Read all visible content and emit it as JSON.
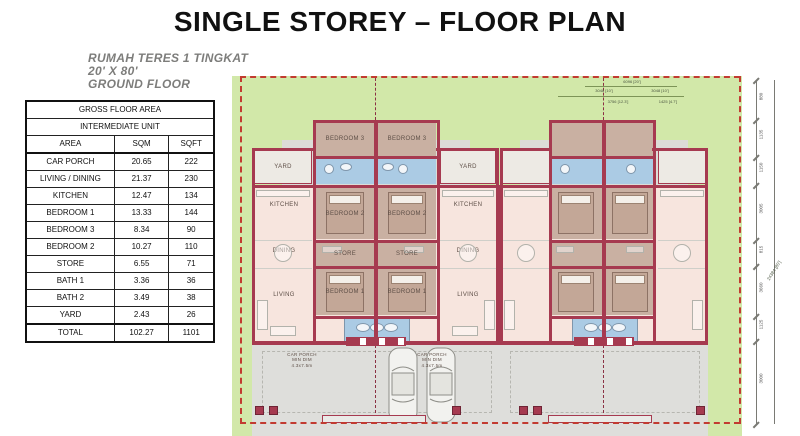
{
  "title": "SINGLE STOREY – FLOOR PLAN",
  "heading": {
    "line1": "RUMAH TERES 1 TINGKAT",
    "line2": "20' X 80'",
    "line3": "GROUND FLOOR"
  },
  "table": {
    "title": "GROSS FLOOR AREA",
    "subtitle": "INTERMEDIATE UNIT",
    "headers": [
      "AREA",
      "SQM",
      "SQFT"
    ],
    "rows": [
      {
        "area": "CAR PORCH",
        "sqm": "20.65",
        "sqft": "222"
      },
      {
        "area": "LIVING / DINING",
        "sqm": "21.37",
        "sqft": "230"
      },
      {
        "area": "KITCHEN",
        "sqm": "12.47",
        "sqft": "134"
      },
      {
        "area": "BEDROOM 1",
        "sqm": "13.33",
        "sqft": "144"
      },
      {
        "area": "BEDROOM 3",
        "sqm": "8.34",
        "sqft": "90"
      },
      {
        "area": "BEDROOM 2",
        "sqm": "10.27",
        "sqft": "110"
      },
      {
        "area": "STORE",
        "sqm": "6.55",
        "sqft": "71"
      },
      {
        "area": "BATH 1",
        "sqm": "3.36",
        "sqft": "36"
      },
      {
        "area": "BATH 2",
        "sqm": "3.49",
        "sqft": "38"
      },
      {
        "area": "YARD",
        "sqm": "2.43",
        "sqft": "26"
      }
    ],
    "total": {
      "area": "TOTAL",
      "sqm": "102.27",
      "sqft": "1101"
    }
  },
  "floorplan": {
    "rooms": {
      "bedroom1": "BEDROOM 1",
      "bedroom2": "BEDROOM 2",
      "bedroom3": "BEDROOM 3",
      "store": "STORE",
      "kitchen": "KITCHEN",
      "yard": "YARD",
      "dining": "DINING",
      "living": "LIVING"
    },
    "car_porch_lines": [
      "CAR PORCH",
      "MIN DIM",
      "4.3x7.5m"
    ],
    "dims_top": [
      "3048 [10']",
      "6096 [20']",
      "3048 [10']",
      "3756 [12.3']",
      "1425 [4.7']"
    ],
    "dims_right": [
      "880",
      "1135",
      "1150",
      "3005",
      "815",
      "3660",
      "1125",
      "3000"
    ],
    "dim_overall": "24384 [80']",
    "colors": {
      "wall": "#a63a50",
      "grass": "#d2e8a9",
      "floor": "#f7e5de",
      "bedroom": "#c9b0a2",
      "bath": "#abcbe4",
      "porch": "#dededb",
      "boundary": "#c23b31"
    }
  }
}
